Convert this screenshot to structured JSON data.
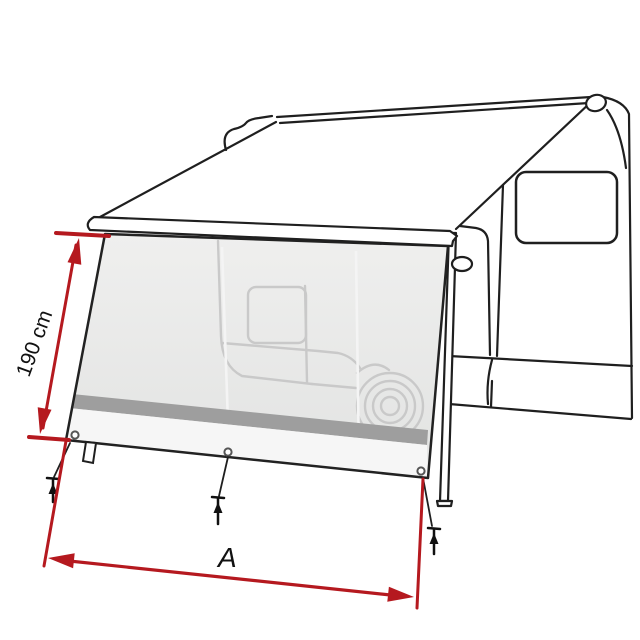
{
  "diagram": {
    "type": "awning-front-panel-technical-illustration",
    "subject": "Caravan with extended awning and front/side sun-view panel, dimension annotations",
    "dimension_labels": {
      "height": "190 cm",
      "width": "A"
    },
    "colors": {
      "dimension_red": "#b5191f",
      "outline_black": "#1f1f1f",
      "panel_gray": "#e9eae9",
      "stripe_gray": "#9e9e9e",
      "skirt_white": "#f6f6f6",
      "silhouette_gray": "#c9c9c9",
      "background": "#ffffff"
    },
    "elements": {
      "panel_grommets": 3,
      "ground_pegs": 3,
      "support_legs": 1
    }
  }
}
